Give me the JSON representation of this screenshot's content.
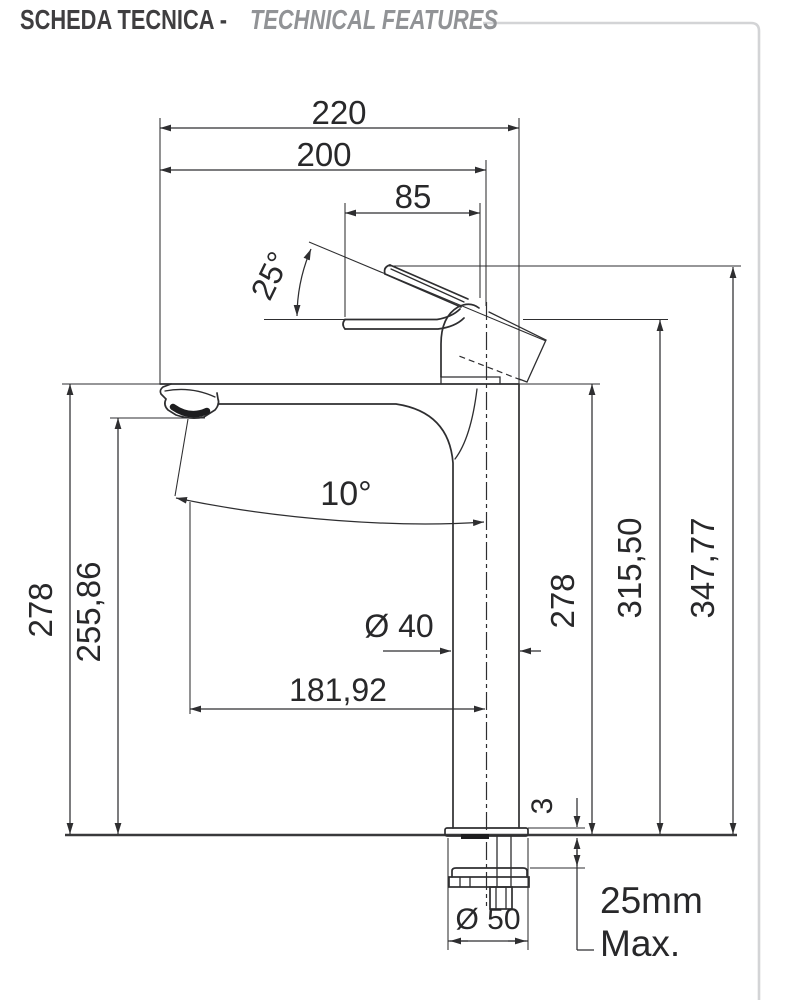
{
  "header": {
    "title_primary": "SCHEDA TECNICA -",
    "title_secondary": "TECHNICAL FEATURES"
  },
  "colors": {
    "line": "#2e2e30",
    "counter_line": "#39393b",
    "frame": "#d3d4d6",
    "title_primary": "#3f3e40",
    "title_secondary": "#919396"
  },
  "drawing": {
    "dims": {
      "total_width": "220",
      "spout_reach": "200",
      "handle_length": "85",
      "handle_angle": "25°",
      "spout_tilt": "10°",
      "height_deck_left": "278",
      "height_outlet": "255,86",
      "height_deck_right": "278",
      "height_handle": "315,50",
      "height_total": "347,77",
      "body_diameter": "Ø 40",
      "outlet_offset": "181,92",
      "plate_thickness": "3",
      "base_diameter": "Ø 50",
      "counter_max_line1": "25mm",
      "counter_max_line2": "Max."
    }
  }
}
